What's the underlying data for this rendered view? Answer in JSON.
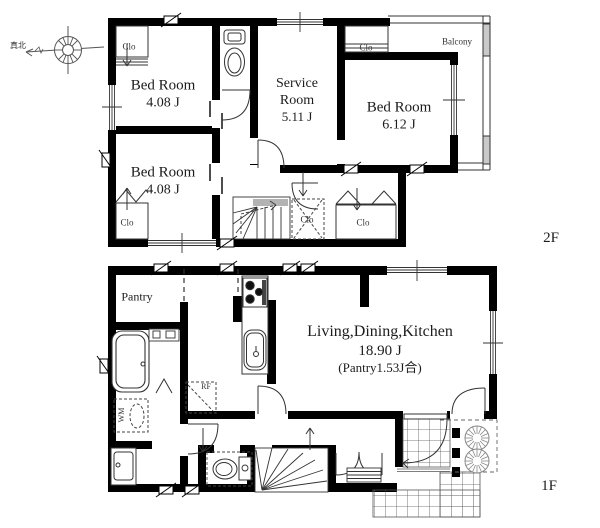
{
  "compass": {
    "label": "真北"
  },
  "floor2": {
    "label": "2F",
    "bedroom_tl": {
      "name": "Bed Room",
      "area": "4.08 J"
    },
    "bedroom_bl": {
      "name": "Bed Room",
      "area": "4.08 J"
    },
    "service": {
      "name": "Service Room",
      "area": "5.11 J"
    },
    "bedroom_r": {
      "name": "Bed Room",
      "area": "6.12 J"
    },
    "balcony": "Balcony",
    "closets": [
      "Clo",
      "Clo",
      "Clo",
      "Clo",
      "Clo"
    ]
  },
  "floor1": {
    "label": "1F",
    "ldk": {
      "name": "Living,Dining,Kitchen",
      "area": "18.90 J",
      "note": "(Pantry1.53J合)"
    },
    "pantry": "Pantry",
    "washing_machine": "WM",
    "refrigerator": "RF"
  }
}
